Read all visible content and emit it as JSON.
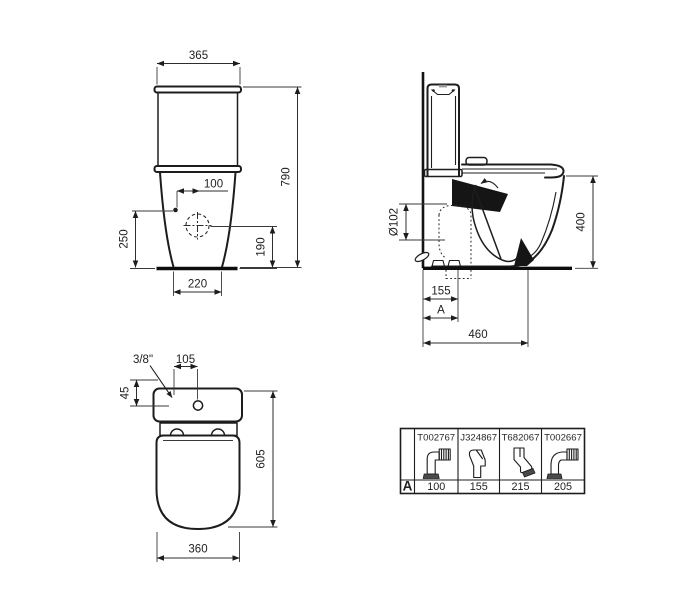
{
  "meta": {
    "background_color": "#ffffff",
    "line_color": "#1d1d1d",
    "text_color": "#1e1e1e"
  },
  "front_view": {
    "label": "front elevation of close-coupled WC",
    "dim_cistern_width": "365",
    "dim_total_height": "790",
    "dim_fixing_offset": "100",
    "dim_fixing_height": "250",
    "dim_outlet_height": "190",
    "dim_base_width": "220"
  },
  "side_view": {
    "label": "side elevation of close-coupled WC",
    "dim_seat_height": "400",
    "dim_outlet_diameter": "Ø102",
    "dim_outlet_distance": "155",
    "dim_variable": "A",
    "dim_depth": "460"
  },
  "plan_view": {
    "label": "plan view of close-coupled WC",
    "dim_inlet_thread": "3/8\"",
    "dim_inlet_offset": "105",
    "dim_inlet_depth": "45",
    "dim_length": "605",
    "dim_width": "360"
  },
  "outlet_table": {
    "row_label": "A",
    "columns": [
      {
        "code": "T002767",
        "a_value": "100",
        "icon": "elbow-90-ribbed-connector-icon"
      },
      {
        "code": "J324867",
        "a_value": "155",
        "icon": "offset-straight-connector-icon"
      },
      {
        "code": "T682067",
        "a_value": "215",
        "icon": "angled-45-connector-icon"
      },
      {
        "code": "T002667",
        "a_value": "205",
        "icon": "curved-90-ribbed-connector-icon"
      }
    ]
  }
}
